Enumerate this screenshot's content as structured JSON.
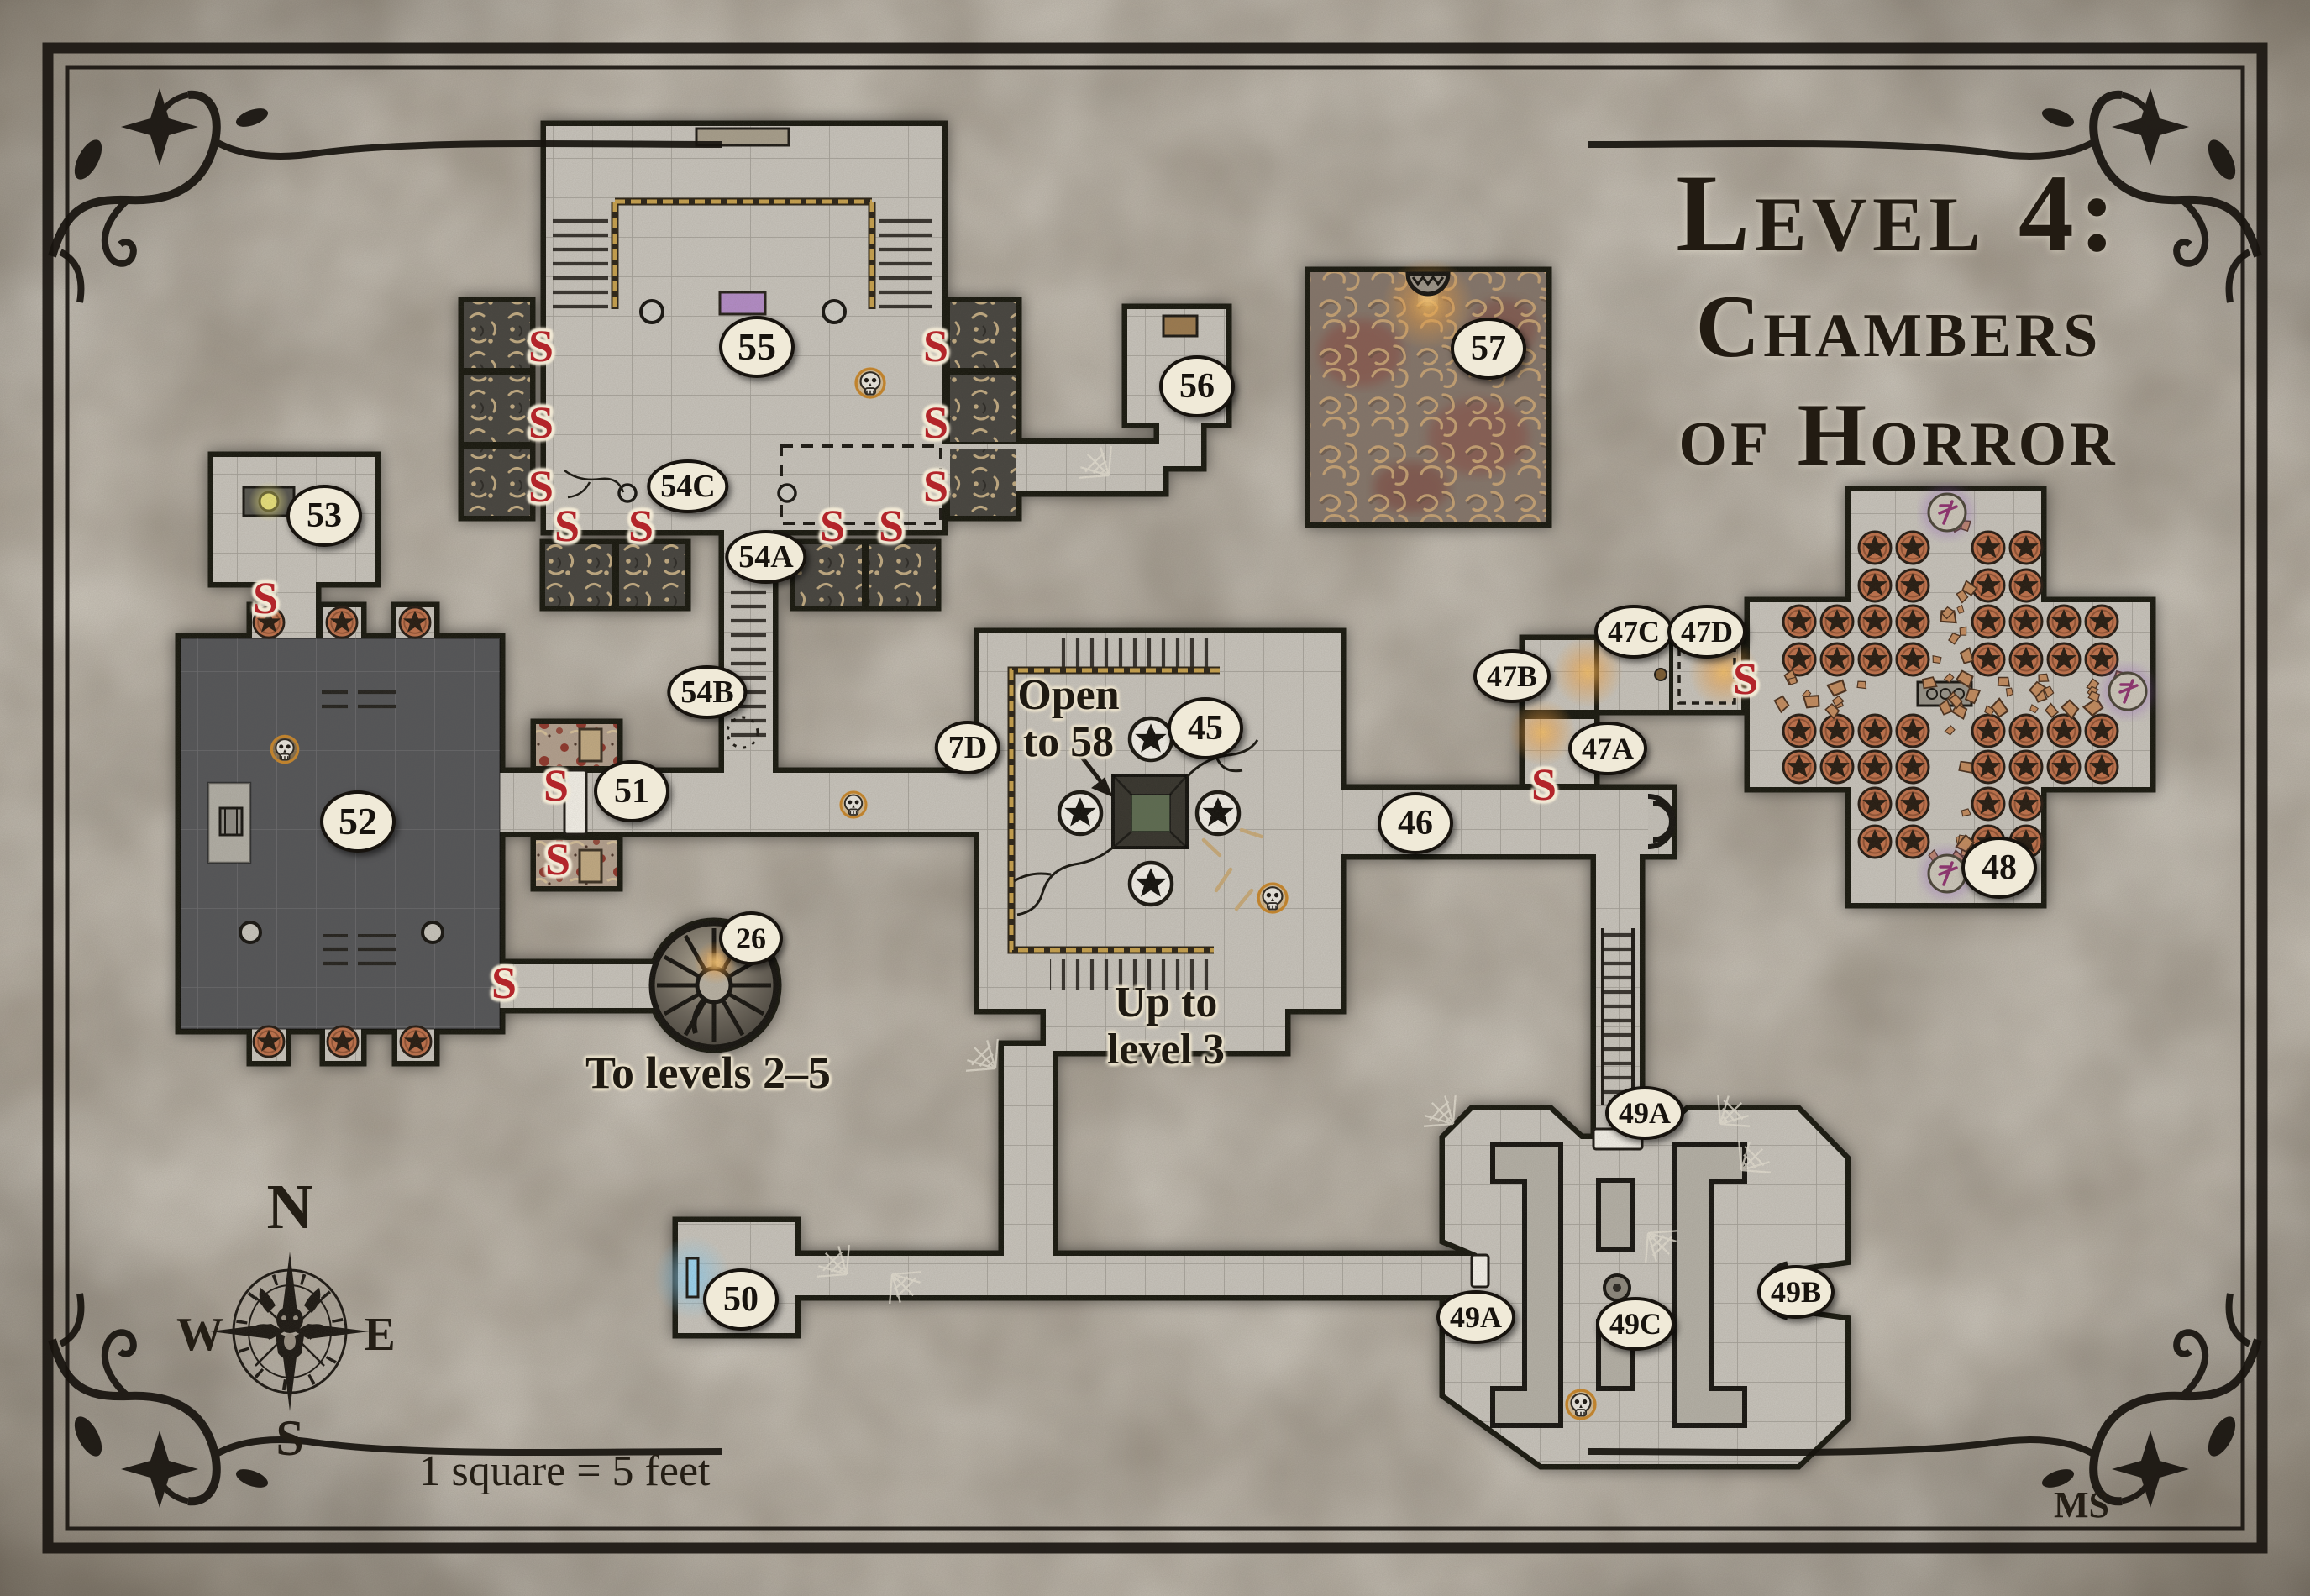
{
  "title": {
    "line1": "Level 4:",
    "line2": "Chambers",
    "line3": "of Horror"
  },
  "scale_note": "1 square = 5 feet",
  "signature": "MS",
  "secret_door_marker": "S",
  "compass": {
    "north": "N",
    "east": "E",
    "south": "S",
    "west": "W"
  },
  "annotations": {
    "open_to_58_line1": "Open",
    "open_to_58_line2": "to 58",
    "up_to_level3_line1": "Up to",
    "up_to_level3_line2": "level 3",
    "to_levels": "To levels 2–5"
  },
  "rooms": {
    "55": {
      "label": "55"
    },
    "54A": {
      "label": "54A"
    },
    "54B": {
      "label": "54B"
    },
    "54C": {
      "label": "54C"
    },
    "53": {
      "label": "53"
    },
    "52": {
      "label": "52"
    },
    "51": {
      "label": "51"
    },
    "26": {
      "label": "26"
    },
    "7D": {
      "label": "7D"
    },
    "45": {
      "label": "45"
    },
    "46": {
      "label": "46"
    },
    "47A": {
      "label": "47A"
    },
    "47B": {
      "label": "47B"
    },
    "47C": {
      "label": "47C"
    },
    "47D": {
      "label": "47D"
    },
    "48": {
      "label": "48"
    },
    "49A": {
      "label": "49A"
    },
    "49B": {
      "label": "49B"
    },
    "49C": {
      "label": "49C"
    },
    "50": {
      "label": "50"
    },
    "56": {
      "label": "56"
    },
    "57": {
      "label": "57"
    }
  },
  "colors": {
    "secret_marker": "#b3252a",
    "badge_bg": "#f0ead8",
    "chain_gold": "#c8a14c",
    "copper_star": "#c0714b",
    "altar_purple": "#b48cc8",
    "glyph_purple": "#8f3070",
    "pit_green": "#5c6b50",
    "glow_orange": "#f0a848",
    "glow_blue": "#7ec4e8",
    "glow_yellow": "#e9e27b",
    "dark_room_floor": "#4b4c50"
  }
}
